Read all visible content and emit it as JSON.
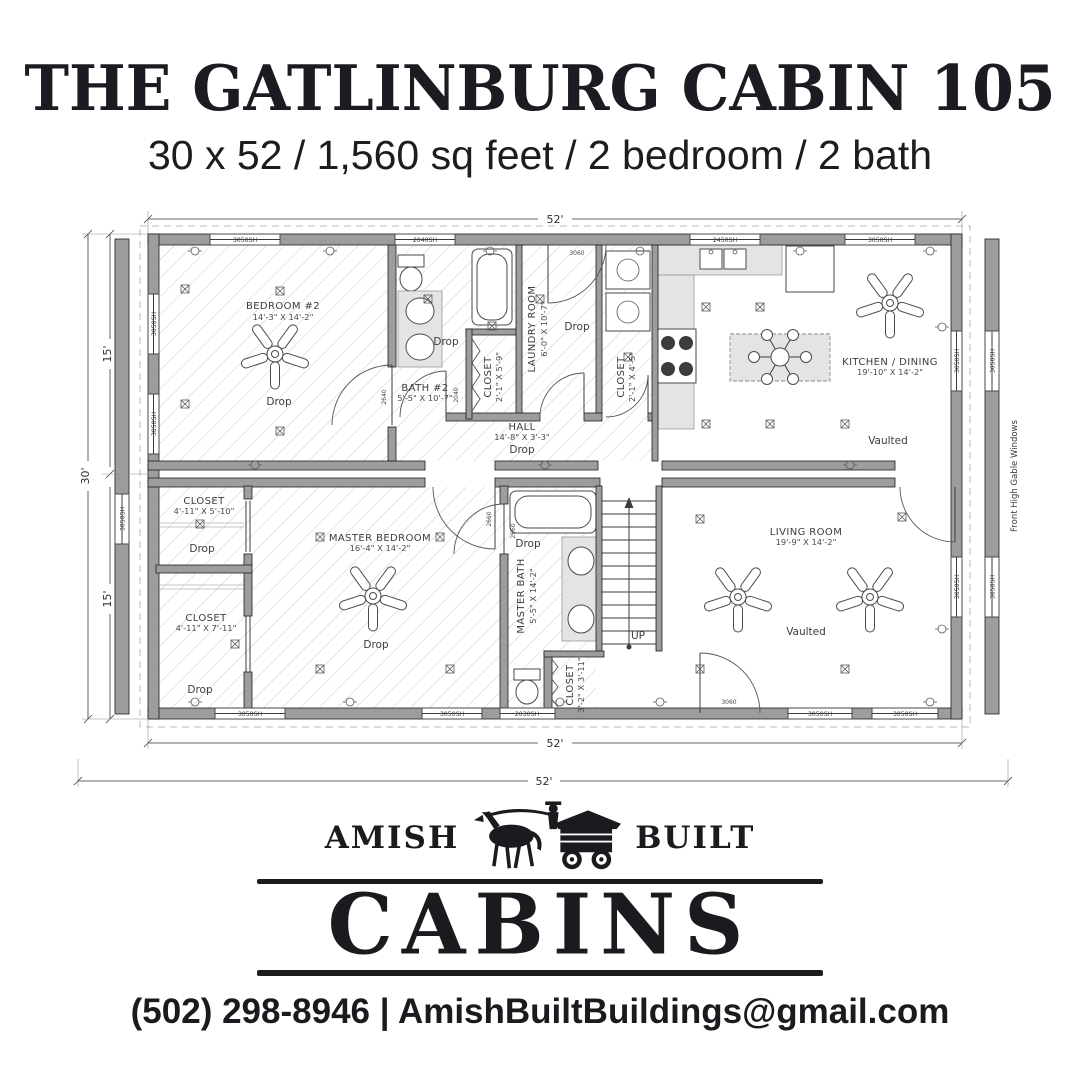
{
  "header": {
    "title": "THE GATLINBURG CABIN 105",
    "subtitle": "30 x 52 / 1,560 sq feet / 2 bedroom / 2 bath"
  },
  "plan": {
    "dim_labels": {
      "top": "52'",
      "bottom": "52'",
      "overall": "52'",
      "left": "30'",
      "upper": "15'",
      "lower": "15'"
    },
    "rooms": [
      {
        "name": "BEDROOM #2",
        "dims": "14'-3\" X 14'-2\"",
        "ceiling": "Drop"
      },
      {
        "name": "BATH #2",
        "dims": "5'-5\" X 10'-7\"",
        "ceiling": "Drop"
      },
      {
        "name": "CLOSET",
        "dims": "2'-1\" X 5'-9\""
      },
      {
        "name": "LAUNDRY ROOM",
        "dims": "6'-0\" X 10'-7\"",
        "ceiling": "Drop"
      },
      {
        "name": "CLOSET",
        "dims": "2'-1\" X 4'-5\""
      },
      {
        "name": "HALL",
        "dims": "14'-8\" X 3'-3\"",
        "ceiling": "Drop"
      },
      {
        "name": "KITCHEN / DINING",
        "dims": "19'-10\" X 14'-2\"",
        "ceiling": "Vaulted"
      },
      {
        "name": "MASTER BEDROOM",
        "dims": "16'-4\" X 14'-2\"",
        "ceiling": "Drop"
      },
      {
        "name": "CLOSET",
        "dims": "4'-11\" X 5'-10\"",
        "ceiling": "Drop"
      },
      {
        "name": "CLOSET",
        "dims": "4'-11\" X 7'-11\"",
        "ceiling": "Drop"
      },
      {
        "name": "MASTER BATH",
        "dims": "5'-5\" X 14'-2\"",
        "ceiling": "Drop"
      },
      {
        "name": "CLOSET",
        "dims": "3'-2\" X 3'-11\""
      },
      {
        "name": "LIVING ROOM",
        "dims": "19'-9\" X 14'-2\"",
        "ceiling": "Vaulted"
      }
    ],
    "stairs_label": "UP",
    "gable_note": "Front High Gable Windows",
    "window_labels": [
      "3050SH",
      "2040SH",
      "2450SH",
      "3050SH",
      "3050SH",
      "3050SH",
      "2030SH",
      "3050SH",
      "3050SH",
      "3050SH",
      "3050SH",
      "3050SH",
      "3050SH",
      "3050SH",
      "3050SH",
      "3050SH"
    ],
    "door_labels": [
      "3060",
      "3060",
      "2640",
      "2040",
      "2660",
      "2660"
    ]
  },
  "footer": {
    "brand_left": "AMISH",
    "brand_right": "BUILT",
    "brand_main": "CABINS",
    "contact": "(502) 298-8946 | AmishBuiltBuildings@gmail.com"
  }
}
